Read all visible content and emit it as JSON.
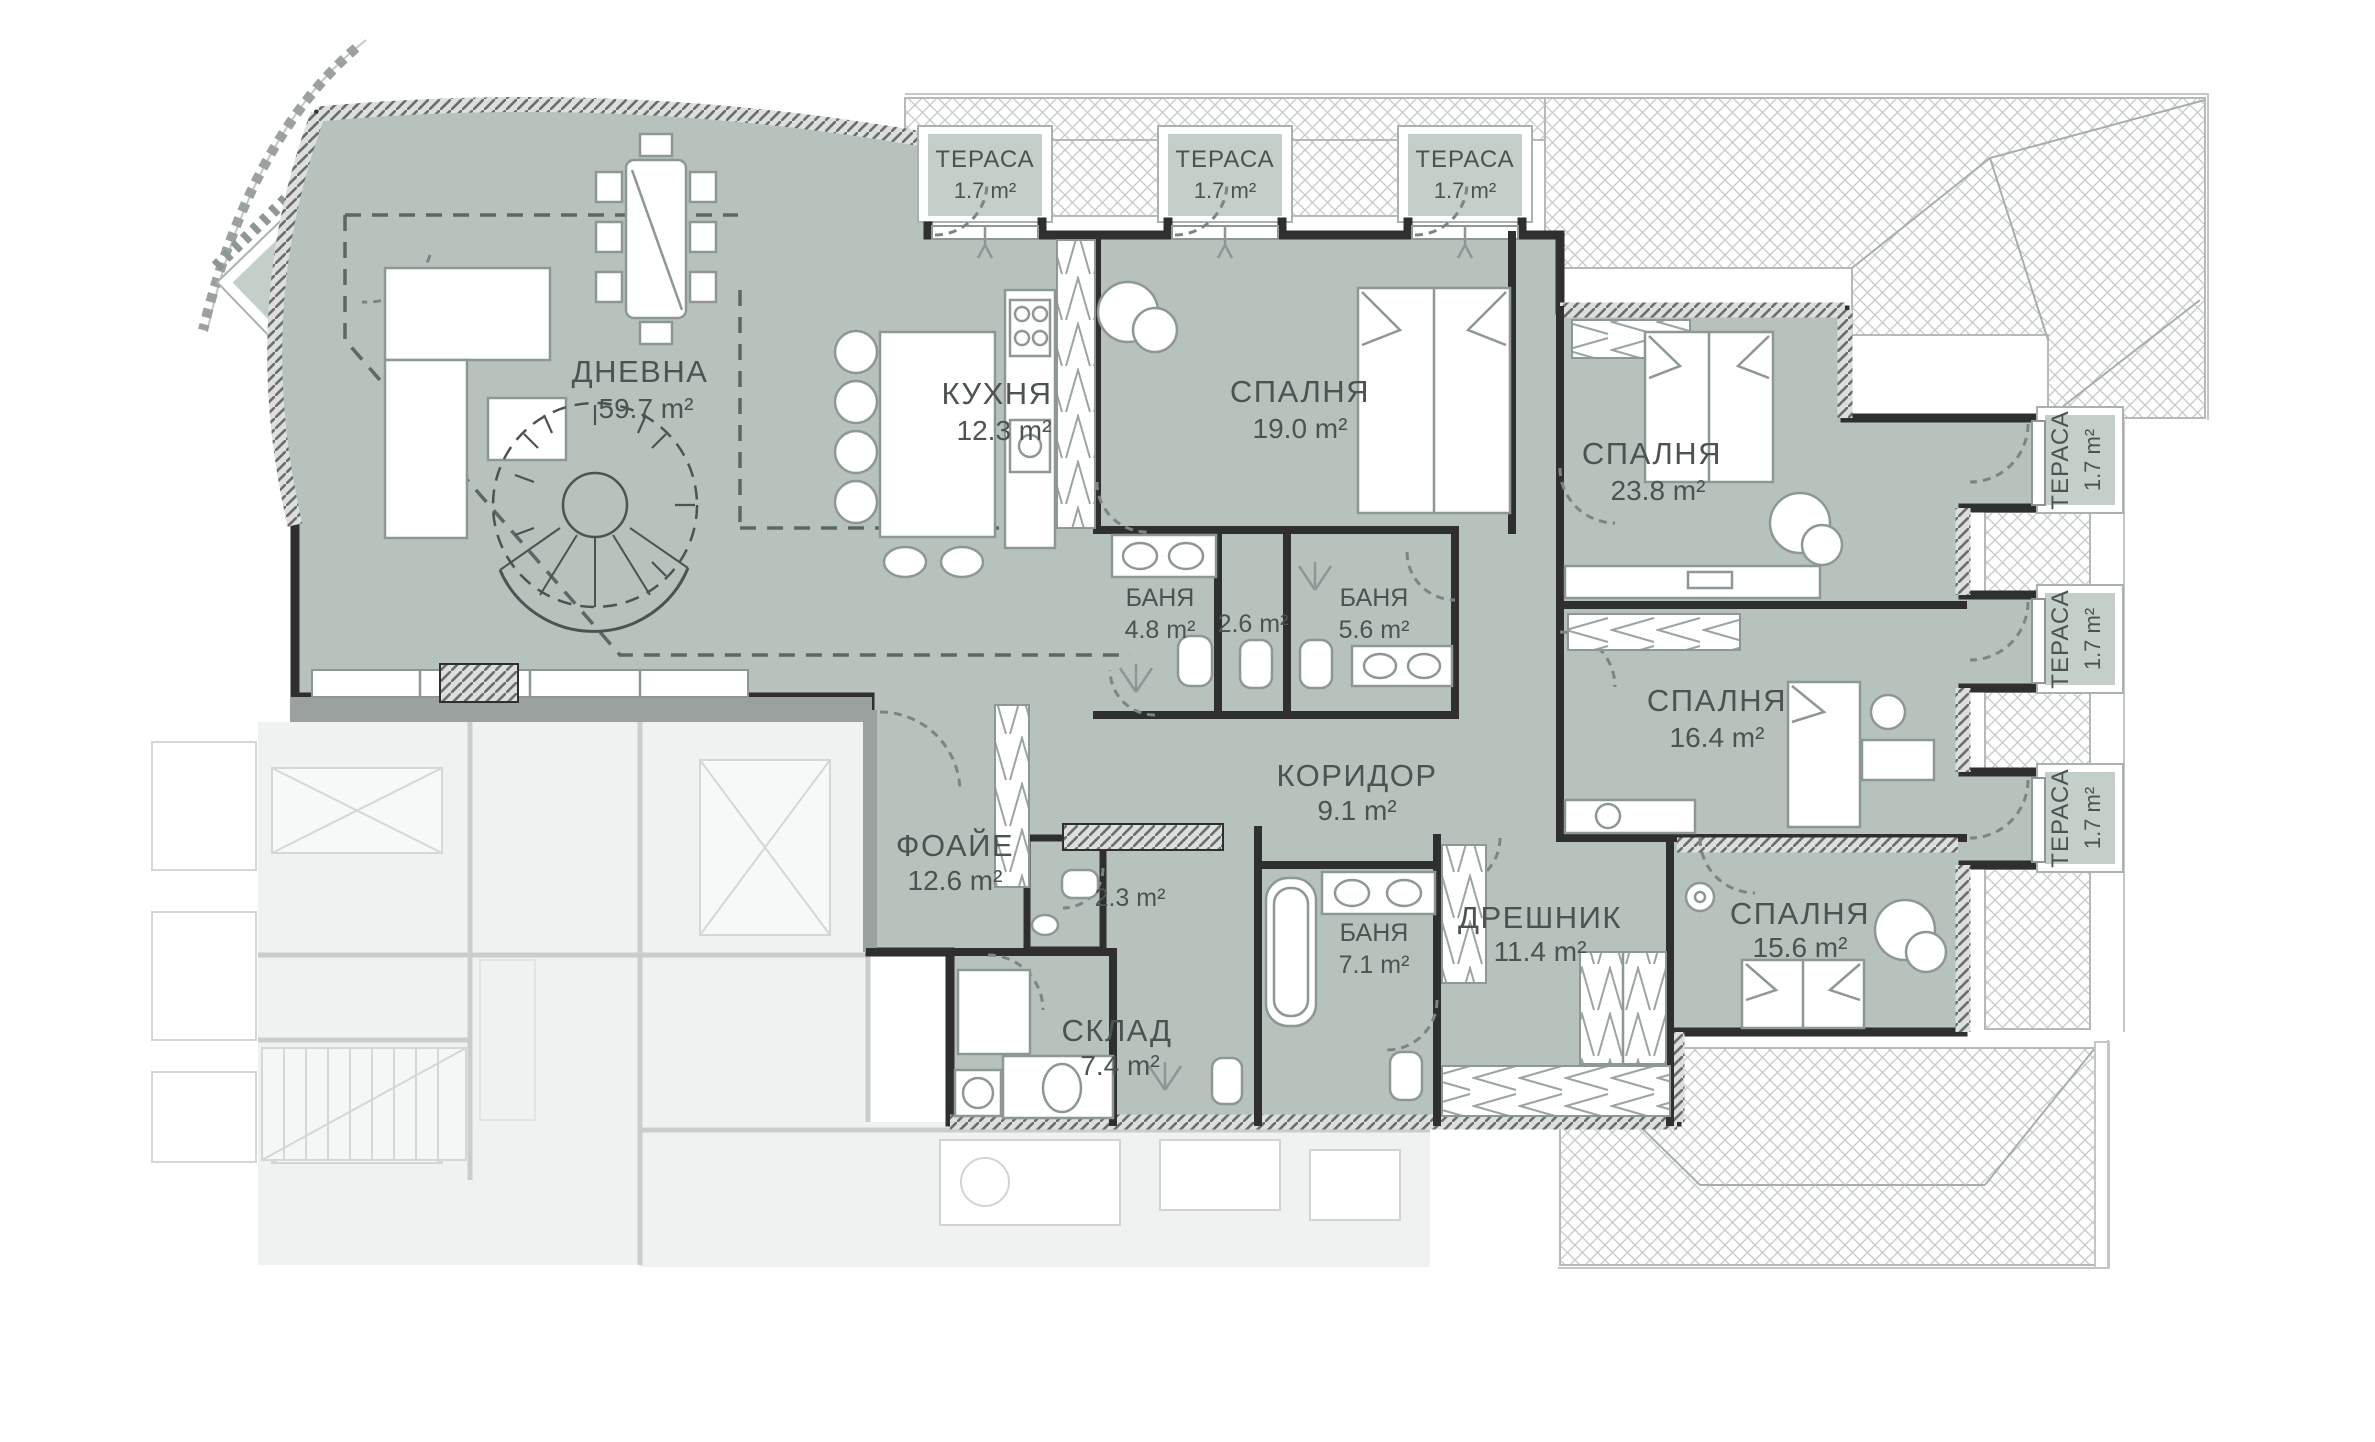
{
  "plan": {
    "colors": {
      "unit": "#b7c2bd",
      "terrace": "#c4cfc9",
      "wall": "#2f2f2f",
      "roof_line": "#c2c6c4",
      "label": "#4c5350",
      "neighbor": "#f0f2f1"
    },
    "rooms": {
      "terrace_tl": {
        "name": "ТЕРАСА",
        "area": "3.4 m²"
      },
      "terrace_top_1": {
        "name": "ТЕРАСА",
        "area": "1.7 m²"
      },
      "terrace_top_2": {
        "name": "ТЕРАСА",
        "area": "1.7 m²"
      },
      "terrace_top_3": {
        "name": "ТЕРАСА",
        "area": "1.7 m²"
      },
      "dnevna": {
        "name": "ДНЕВНА",
        "area": "59.7 m²"
      },
      "kuhnya": {
        "name": "КУХНЯ",
        "area": "12.3 m²"
      },
      "spalnya_1": {
        "name": "СПАЛНЯ",
        "area": "19.0 m²"
      },
      "spalnya_2": {
        "name": "СПАЛНЯ",
        "area": "23.8 m²"
      },
      "banya_1": {
        "name": "БАНЯ",
        "area": "4.8 m²"
      },
      "wc_1": {
        "area": "2.6 m²"
      },
      "banya_2": {
        "name": "БАНЯ",
        "area": "5.6 m²"
      },
      "koridor": {
        "name": "КОРИДОР",
        "area": "9.1 m²"
      },
      "spalnya_3": {
        "name": "СПАЛНЯ",
        "area": "16.4 m²"
      },
      "foaie": {
        "name": "ФОАЙЕ",
        "area": "12.6 m²"
      },
      "wc_2": {
        "area": "2.3 m²"
      },
      "banya_3": {
        "name": "БАНЯ",
        "area": "7.1 m²"
      },
      "dreshnik": {
        "name": "ДРЕШНИК",
        "area": "11.4 m²"
      },
      "spalnya_4": {
        "name": "СПАЛНЯ",
        "area": "15.6 m²"
      },
      "sklad": {
        "name": "СКЛАД",
        "area": "7.4 m²"
      },
      "terrace_r_1": {
        "name": "ТЕРАСА",
        "area": "1.7 m²"
      },
      "terrace_r_2": {
        "name": "ТЕРАСА",
        "area": "1.7 m²"
      },
      "terrace_r_3": {
        "name": "ТЕРАСА",
        "area": "1.7 m²"
      }
    }
  }
}
